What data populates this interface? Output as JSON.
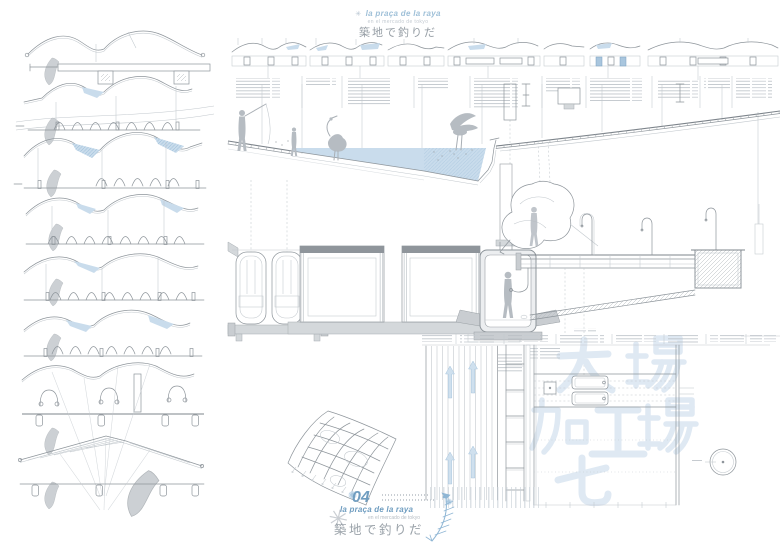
{
  "page": {
    "width": 780,
    "height": 551,
    "background": "#ffffff"
  },
  "colors": {
    "accent_blue": "#6f9dc0",
    "script_blue": "#9fc0d8",
    "water_blue": "#c9dcec",
    "line_gray": "#8e959b",
    "light_gray": "#c2c8cd",
    "fill_gray": "#d4d8db",
    "watermark_blue": "#dfe9f3",
    "jp_text_gray": "#959da4"
  },
  "icons": {
    "starburst": "✳",
    "sparkle": "✺"
  },
  "header": {
    "script_title": "la praça de la raya",
    "subtitle": "en el mercado de tokyo",
    "jp_title": "築地で釣りだ"
  },
  "title_block": {
    "number": "04",
    "script_title": "la praça de la raya",
    "subtitle": "en el mercado de tokyo",
    "jp_title": "築地で釣りだ"
  },
  "watermarks": {
    "chars": [
      "大",
      "場",
      "加",
      "工",
      "場",
      "七"
    ]
  }
}
